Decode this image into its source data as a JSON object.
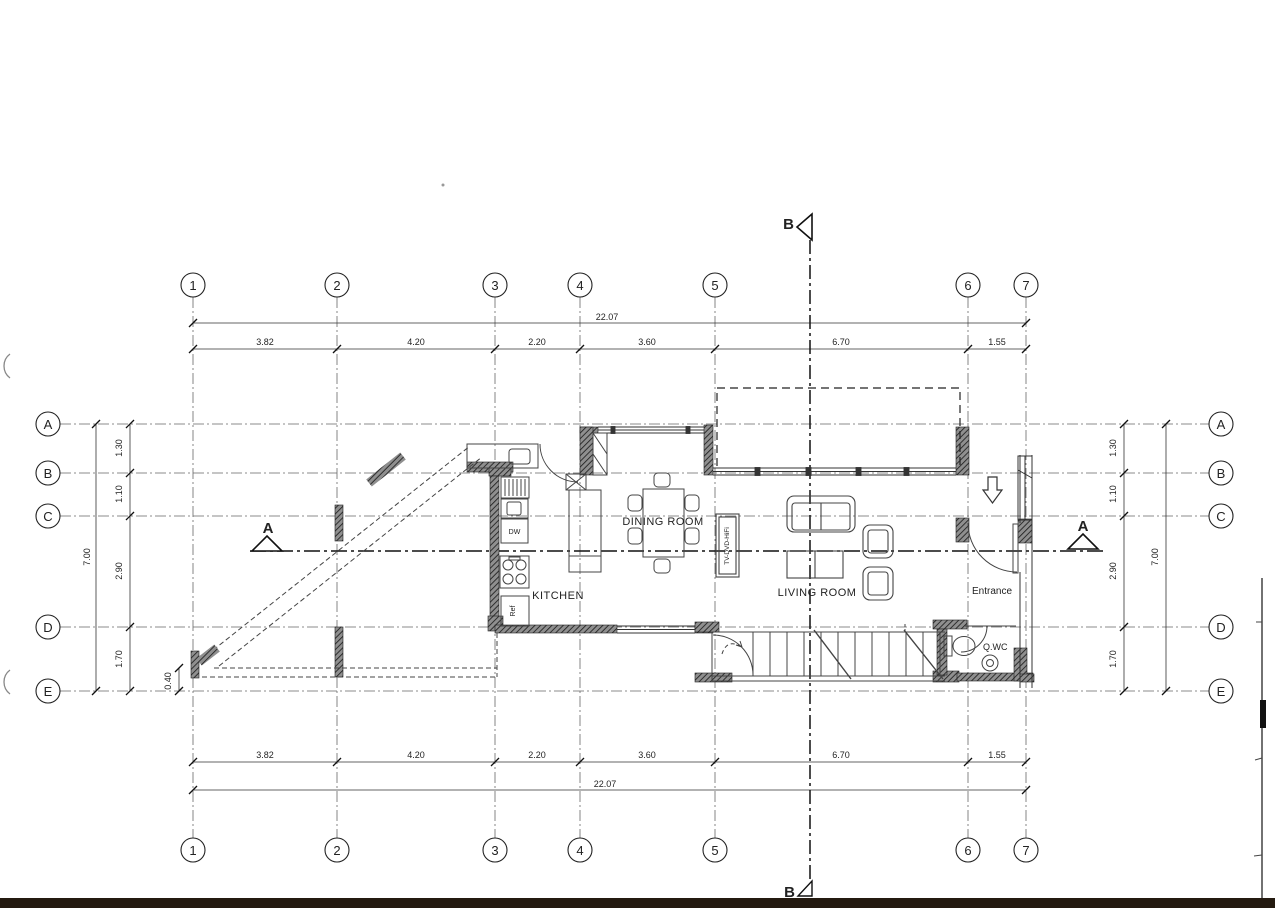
{
  "colors": {
    "paper": "#ffffff",
    "ink": "#2b2b2b",
    "wall_fill": "#8f8f8f",
    "page_edge": "#241a10"
  },
  "grid": {
    "cols": [
      {
        "label": "1"
      },
      {
        "label": "2"
      },
      {
        "label": "3"
      },
      {
        "label": "4"
      },
      {
        "label": "5"
      },
      {
        "label": "6"
      },
      {
        "label": "7"
      }
    ],
    "rows": [
      {
        "label": "A"
      },
      {
        "label": "B"
      },
      {
        "label": "C"
      },
      {
        "label": "D"
      },
      {
        "label": "E"
      }
    ]
  },
  "dims": {
    "top_total": "22.07",
    "top_segments": [
      "3.82",
      "4.20",
      "2.20",
      "3.60",
      "6.70",
      "1.55"
    ],
    "bottom_total": "22.07",
    "bottom_segments": [
      "3.82",
      "4.20",
      "2.20",
      "3.60",
      "6.70",
      "1.55"
    ],
    "left_total": "7.00",
    "left_segments": [
      "1.30",
      "1.10",
      "2.90",
      "1.70"
    ],
    "right_total": "7.00",
    "right_segments": [
      "1.30",
      "1.10",
      "2.90",
      "1.70"
    ],
    "offset": "0.40"
  },
  "rooms": {
    "kitchen": "KITCHEN",
    "dining": "DINING ROOM",
    "living": "LIVING ROOM",
    "entrance": "Entrance",
    "wc": "Q.WC"
  },
  "furniture": {
    "tv_unit": "TV-DVD-HiFi",
    "dishwasher": "DW",
    "refrigerator": "Ref"
  },
  "sections": {
    "a": "A",
    "b": "B"
  }
}
